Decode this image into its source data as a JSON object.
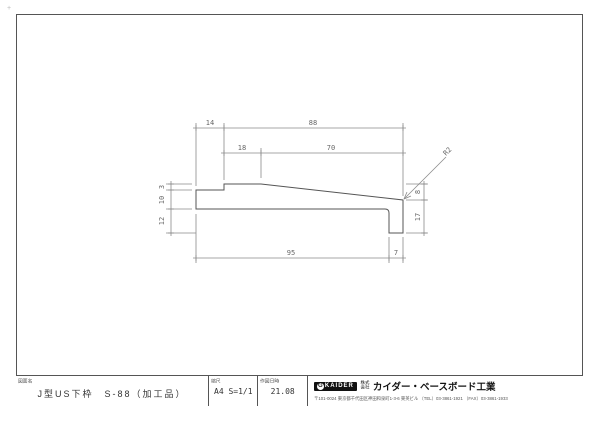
{
  "title_block": {
    "drawing_name_label": "図面名",
    "drawing_name": "J型US下枠　S-88（加工品）",
    "scale_label": "縮尺",
    "scale_value": "A4 S=1/1",
    "date_label": "作図日時",
    "date_value": "21.08",
    "company": {
      "logo_mark": "G",
      "logo_text": "KAIDER",
      "corp_prefix_line1": "株式",
      "corp_prefix_line2": "会社",
      "name": "カイダー・ベースボード工業",
      "address": "〒101-0024 東京都千代田区神田和泉町1-3-6 東英ビル （TEL）03-3861-1921 （FAX）03-3861-1933"
    }
  },
  "drawing": {
    "profile_name": "J-type US lower frame cross-section",
    "dims": {
      "top": [
        "14",
        "88"
      ],
      "row2": [
        "18",
        "70"
      ],
      "left": [
        "3",
        "10",
        "12"
      ],
      "right": [
        "8",
        "17"
      ],
      "bottom": [
        "95",
        "7"
      ]
    },
    "leader_label": "R2"
  },
  "reg_mark": "+",
  "colors": {
    "border": "#555555",
    "profile_line": "#555555",
    "dim_line": "#888888",
    "dim_text": "#666666"
  }
}
